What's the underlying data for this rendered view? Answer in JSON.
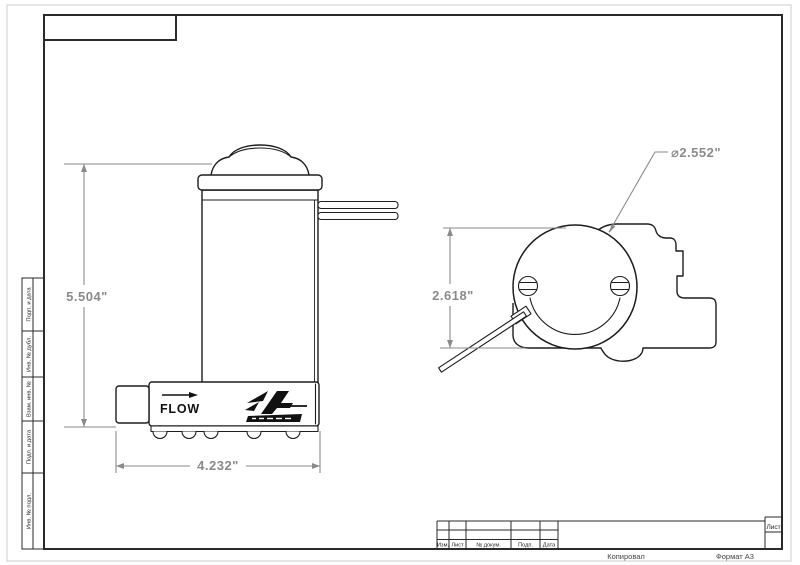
{
  "sheet": {
    "footer_copied": "Копировал",
    "footer_format": "Формат А3"
  },
  "frame": {
    "left_strip_labels": [
      "Подп. и дата",
      "Инв. № дубл.",
      "Взам. инв. №",
      "Подп. и дата",
      "Инв. № подл."
    ]
  },
  "title_block": {
    "columns": [
      "Изм.",
      "Лист",
      "№ докум.",
      "Подп.",
      "Дата"
    ],
    "sheet_label": "Лист"
  },
  "side_view": {
    "flow_label": "FLOW",
    "dim_height": "5.504\"",
    "dim_width": "4.232\"",
    "logo_icon": "aeromotive-logo"
  },
  "end_view": {
    "dim_height": "2.618\"",
    "dim_diameter": "⌀2.552\""
  },
  "colors": {
    "line": "#1d1d1d",
    "dimension": "#8a8a8a",
    "frame": "#2a2a2a"
  }
}
